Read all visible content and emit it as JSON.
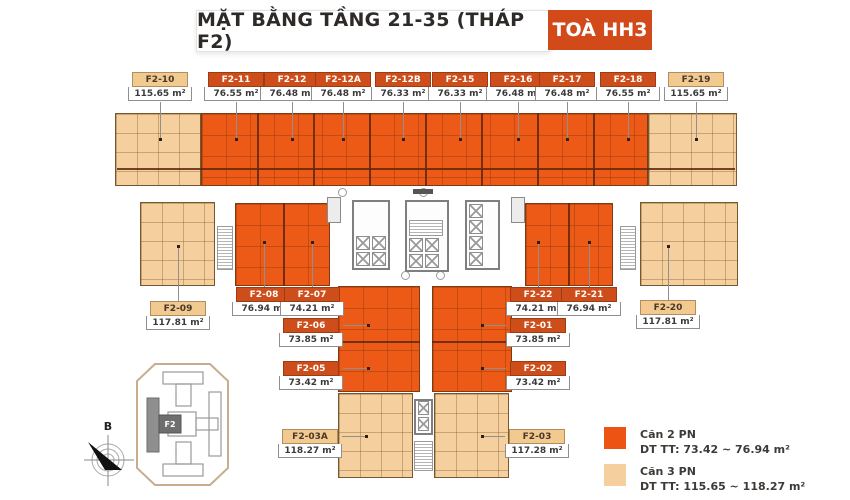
{
  "title": {
    "text": "MẶT BẰNG TẦNG 21-35 (THÁP F2)",
    "badge": "TOÀ HH3"
  },
  "units": [
    {
      "id": "F2-10",
      "area": "115.65 m²",
      "type": "3PN"
    },
    {
      "id": "F2-11",
      "area": "76.55 m²",
      "type": "2PN"
    },
    {
      "id": "F2-12",
      "area": "76.48 m²",
      "type": "2PN"
    },
    {
      "id": "F2-12A",
      "area": "76.48 m²",
      "type": "2PN"
    },
    {
      "id": "F2-12B",
      "area": "76.33 m²",
      "type": "2PN"
    },
    {
      "id": "F2-15",
      "area": "76.33 m²",
      "type": "2PN"
    },
    {
      "id": "F2-16",
      "area": "76.48 m²",
      "type": "2PN"
    },
    {
      "id": "F2-17",
      "area": "76.48 m²",
      "type": "2PN"
    },
    {
      "id": "F2-18",
      "area": "76.55 m²",
      "type": "2PN"
    },
    {
      "id": "F2-19",
      "area": "115.65 m²",
      "type": "3PN"
    },
    {
      "id": "F2-09",
      "area": "117.81 m²",
      "type": "3PN"
    },
    {
      "id": "F2-08",
      "area": "76.94 m²",
      "type": "2PN"
    },
    {
      "id": "F2-07",
      "area": "74.21 m²",
      "type": "2PN"
    },
    {
      "id": "F2-22",
      "area": "74.21 m²",
      "type": "2PN"
    },
    {
      "id": "F2-21",
      "area": "76.94 m²",
      "type": "2PN"
    },
    {
      "id": "F2-20",
      "area": "117.81 m²",
      "type": "3PN"
    },
    {
      "id": "F2-06",
      "area": "73.85 m²",
      "type": "2PN"
    },
    {
      "id": "F2-01",
      "area": "73.85 m²",
      "type": "2PN"
    },
    {
      "id": "F2-05",
      "area": "73.42 m²",
      "type": "2PN"
    },
    {
      "id": "F2-02",
      "area": "73.42 m²",
      "type": "2PN"
    },
    {
      "id": "F2-03A",
      "area": "118.27 m²",
      "type": "3PN"
    },
    {
      "id": "F2-03",
      "area": "117.28 m²",
      "type": "3PN"
    }
  ],
  "legend": [
    {
      "name": "Căn 2 PN",
      "range": "DT TT: 73.42 ~ 76.94 m²",
      "color": "#ED5414"
    },
    {
      "name": "Căn 3 PN",
      "range": "DT TT:  115.65 ~ 118.27 m²",
      "color": "#F5CF9D"
    }
  ],
  "minimap": {
    "tower_label": "F2"
  },
  "compass": {
    "north_label": "B"
  },
  "colors": {
    "unit_2pn": "#ED5A17",
    "unit_3pn": "#F5CF9D",
    "label_2pn_header": "#CE4E1B",
    "label_3pn_header": "#F2C98F",
    "badge": "#D2491A"
  }
}
